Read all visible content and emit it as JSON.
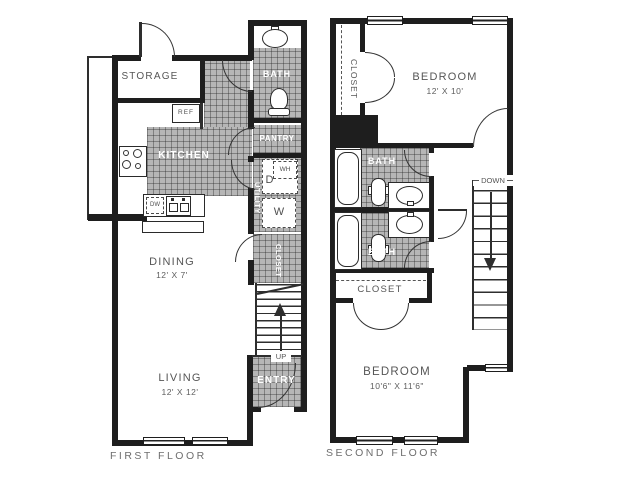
{
  "ff": {
    "caption": "FIRST FLOOR",
    "storage": "STORAGE",
    "kitchen": "KITCHEN",
    "bath": "BATH",
    "pantry": "PANTRY",
    "utility": "UTILITY",
    "closet": "CLOSET",
    "entry": "ENTRY",
    "up": "UP",
    "ref": "REF",
    "dw": "DW",
    "wh": "WH",
    "dryer": "D",
    "washer": "W",
    "dining_name": "DINING",
    "dining_dims": "12' X 7'",
    "living_name": "LIVING",
    "living_dims": "12' X 12'"
  },
  "sf": {
    "caption": "SECOND FLOOR",
    "closet_top": "CLOSET",
    "closet_bottom": "CLOSET",
    "bath_top": "BATH",
    "bath_bottom": "BATH",
    "down": "DOWN",
    "bedroom_top_name": "BEDROOM",
    "bedroom_top_dims": "12' X 10'",
    "bedroom_bottom_name": "BEDROOM",
    "bedroom_bottom_dims": "10'6\" X 11'6\""
  },
  "colors": {
    "wall": "#1e1e1e",
    "tile_fill": "#b6b6b6",
    "label_gray": "#565656",
    "label_white": "#ffffff"
  }
}
